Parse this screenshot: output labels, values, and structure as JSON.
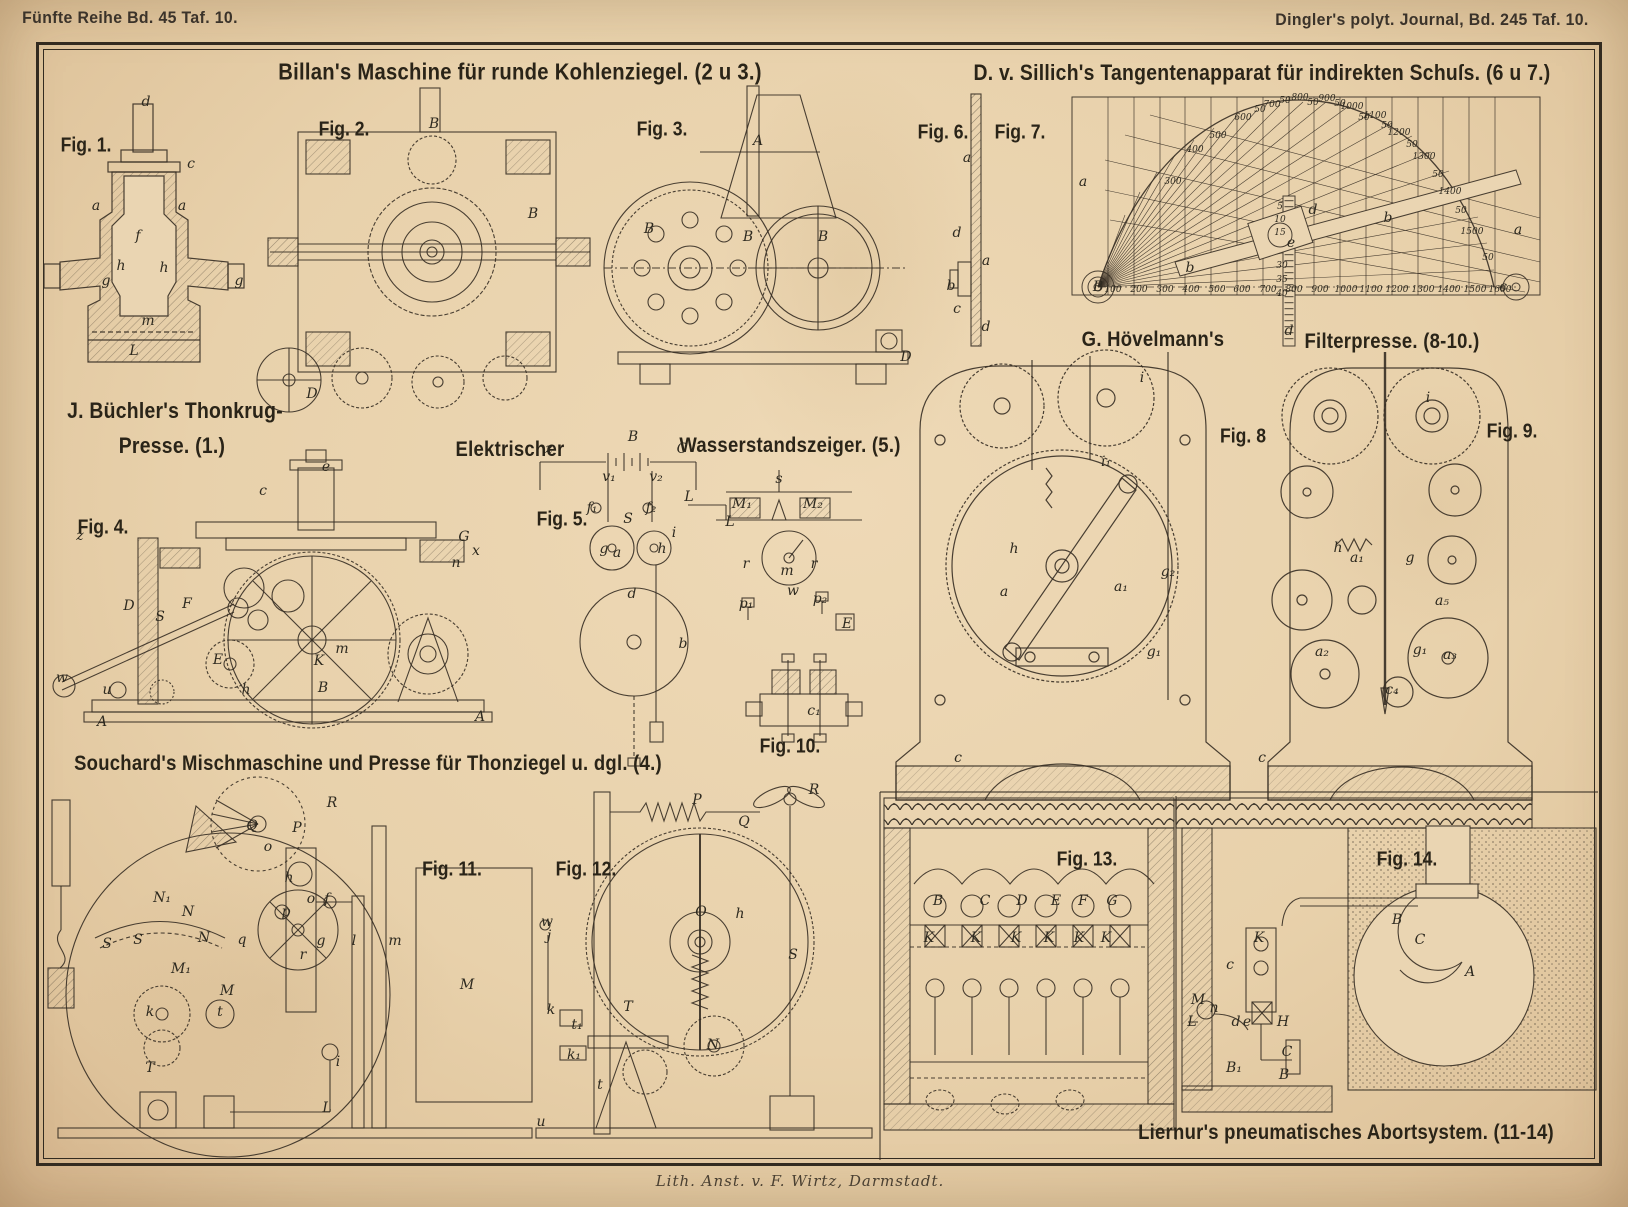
{
  "page": {
    "header_left": "Fünfte Reihe Bd. 45 Taf. 10.",
    "header_right": "Dingler's polyt. Journal, Bd. 245 Taf. 10.",
    "imprint": "Lith. Anst. v. F. Wirtz, Darmstadt."
  },
  "titles": [
    {
      "t": "Billan's Maschine für runde Kohlenziegel. (2 u 3.)",
      "x": 520,
      "y": 72,
      "s": 23
    },
    {
      "t": "D. v. Sillich's Tangentenapparat für indirekten Schuſs. (6 u 7.)",
      "x": 1262,
      "y": 73,
      "s": 22
    },
    {
      "t": "J. Büchler's Thonkrug-",
      "x": 175,
      "y": 411,
      "s": 22
    },
    {
      "t": "Presse. (1.)",
      "x": 172,
      "y": 446,
      "s": 22
    },
    {
      "t": "Elektrischer",
      "x": 510,
      "y": 450,
      "s": 21
    },
    {
      "t": "Wasserstandszeiger. (5.)",
      "x": 790,
      "y": 446,
      "s": 21
    },
    {
      "t": "G. Hövelmann's",
      "x": 1153,
      "y": 340,
      "s": 21
    },
    {
      "t": "Filterpresse. (8-10.)",
      "x": 1392,
      "y": 342,
      "s": 21
    },
    {
      "t": "Souchard's Mischmaschine und Presse für Thonziegel u. dgl. (4.)",
      "x": 368,
      "y": 764,
      "s": 21
    },
    {
      "t": "Liernur's pneumatisches Abortsystem. (11-14)",
      "x": 1346,
      "y": 1133,
      "s": 21
    }
  ],
  "figure_labels": [
    {
      "t": "Fig. 1.",
      "x": 86,
      "y": 146
    },
    {
      "t": "Fig. 2.",
      "x": 344,
      "y": 130
    },
    {
      "t": "Fig. 3.",
      "x": 662,
      "y": 130
    },
    {
      "t": "Fig. 4.",
      "x": 103,
      "y": 528
    },
    {
      "t": "Fig. 5.",
      "x": 562,
      "y": 520
    },
    {
      "t": "Fig. 6.",
      "x": 943,
      "y": 133
    },
    {
      "t": "Fig. 7.",
      "x": 1020,
      "y": 133
    },
    {
      "t": "Fig. 8",
      "x": 1243,
      "y": 437
    },
    {
      "t": "Fig. 9.",
      "x": 1512,
      "y": 432
    },
    {
      "t": "Fig. 10.",
      "x": 790,
      "y": 747
    },
    {
      "t": "Fig. 11.",
      "x": 452,
      "y": 870
    },
    {
      "t": "Fig. 12.",
      "x": 586,
      "y": 870
    },
    {
      "t": "Fig. 13.",
      "x": 1087,
      "y": 860
    },
    {
      "t": "Fig. 14.",
      "x": 1407,
      "y": 860
    }
  ],
  "part_labels": [
    {
      "t": "d",
      "x": 146,
      "y": 102
    },
    {
      "t": "c",
      "x": 191,
      "y": 164
    },
    {
      "t": "a",
      "x": 96,
      "y": 206
    },
    {
      "t": "a",
      "x": 182,
      "y": 206
    },
    {
      "t": "f",
      "x": 138,
      "y": 236
    },
    {
      "t": "h",
      "x": 121,
      "y": 266
    },
    {
      "t": "h",
      "x": 164,
      "y": 268
    },
    {
      "t": "g",
      "x": 106,
      "y": 281
    },
    {
      "t": "g",
      "x": 239,
      "y": 281
    },
    {
      "t": "m",
      "x": 148,
      "y": 321
    },
    {
      "t": "L",
      "x": 134,
      "y": 351
    },
    {
      "t": "B",
      "x": 434,
      "y": 124
    },
    {
      "t": "B",
      "x": 533,
      "y": 214
    },
    {
      "t": "D",
      "x": 312,
      "y": 394
    },
    {
      "t": "A",
      "x": 758,
      "y": 141
    },
    {
      "t": "B",
      "x": 649,
      "y": 229
    },
    {
      "t": "B",
      "x": 748,
      "y": 237
    },
    {
      "t": "B",
      "x": 823,
      "y": 237
    },
    {
      "t": "D",
      "x": 906,
      "y": 357
    },
    {
      "t": "z",
      "x": 80,
      "y": 536
    },
    {
      "t": "e",
      "x": 326,
      "y": 467
    },
    {
      "t": "c",
      "x": 263,
      "y": 491
    },
    {
      "t": "G",
      "x": 464,
      "y": 537
    },
    {
      "t": "x",
      "x": 476,
      "y": 551
    },
    {
      "t": "n",
      "x": 456,
      "y": 563
    },
    {
      "t": "F",
      "x": 187,
      "y": 604
    },
    {
      "t": "S",
      "x": 160,
      "y": 617
    },
    {
      "t": "D",
      "x": 129,
      "y": 606
    },
    {
      "t": "E",
      "x": 218,
      "y": 660
    },
    {
      "t": "m",
      "x": 342,
      "y": 649
    },
    {
      "t": "K",
      "x": 319,
      "y": 661
    },
    {
      "t": "B",
      "x": 323,
      "y": 688
    },
    {
      "t": "h",
      "x": 246,
      "y": 690
    },
    {
      "t": "w",
      "x": 62,
      "y": 678
    },
    {
      "t": "u",
      "x": 107,
      "y": 690
    },
    {
      "t": "A",
      "x": 102,
      "y": 722
    },
    {
      "t": "A",
      "x": 480,
      "y": 717
    },
    {
      "t": "z",
      "x": 549,
      "y": 449
    },
    {
      "t": "B",
      "x": 633,
      "y": 437
    },
    {
      "t": "C",
      "x": 682,
      "y": 449
    },
    {
      "t": "v₁",
      "x": 609,
      "y": 477
    },
    {
      "t": "v₂",
      "x": 656,
      "y": 477
    },
    {
      "t": "f₁",
      "x": 592,
      "y": 508
    },
    {
      "t": "f₂",
      "x": 651,
      "y": 508
    },
    {
      "t": "L",
      "x": 689,
      "y": 497
    },
    {
      "t": "L",
      "x": 730,
      "y": 522
    },
    {
      "t": "i",
      "x": 674,
      "y": 533
    },
    {
      "t": "S",
      "x": 628,
      "y": 519
    },
    {
      "t": "g",
      "x": 604,
      "y": 549
    },
    {
      "t": "a",
      "x": 617,
      "y": 553
    },
    {
      "t": "h",
      "x": 662,
      "y": 549
    },
    {
      "t": "d",
      "x": 632,
      "y": 594
    },
    {
      "t": "b",
      "x": 683,
      "y": 644
    },
    {
      "t": "s",
      "x": 779,
      "y": 479
    },
    {
      "t": "M₁",
      "x": 742,
      "y": 504
    },
    {
      "t": "M₂",
      "x": 813,
      "y": 504
    },
    {
      "t": "r",
      "x": 746,
      "y": 564
    },
    {
      "t": "r",
      "x": 814,
      "y": 564
    },
    {
      "t": "m",
      "x": 787,
      "y": 571
    },
    {
      "t": "w",
      "x": 793,
      "y": 591
    },
    {
      "t": "p₁",
      "x": 746,
      "y": 604
    },
    {
      "t": "p₂",
      "x": 820,
      "y": 599
    },
    {
      "t": "E",
      "x": 847,
      "y": 624
    },
    {
      "t": "c₁",
      "x": 814,
      "y": 711
    },
    {
      "t": "a",
      "x": 967,
      "y": 158
    },
    {
      "t": "d",
      "x": 957,
      "y": 233
    },
    {
      "t": "a",
      "x": 986,
      "y": 261
    },
    {
      "t": "b",
      "x": 951,
      "y": 286
    },
    {
      "t": "c",
      "x": 957,
      "y": 309
    },
    {
      "t": "d",
      "x": 986,
      "y": 327
    },
    {
      "t": "a",
      "x": 1083,
      "y": 182
    },
    {
      "t": "b",
      "x": 1190,
      "y": 268
    },
    {
      "t": "b",
      "x": 1388,
      "y": 218
    },
    {
      "t": "d",
      "x": 1313,
      "y": 210
    },
    {
      "t": "e",
      "x": 1291,
      "y": 243
    },
    {
      "t": "a",
      "x": 1518,
      "y": 230
    },
    {
      "t": "c",
      "x": 1503,
      "y": 287
    },
    {
      "t": "d",
      "x": 1289,
      "y": 331
    },
    {
      "t": "i",
      "x": 1142,
      "y": 378
    },
    {
      "t": "i₁",
      "x": 1106,
      "y": 462
    },
    {
      "t": "h",
      "x": 1014,
      "y": 549
    },
    {
      "t": "g₂",
      "x": 1168,
      "y": 572
    },
    {
      "t": "a",
      "x": 1004,
      "y": 592
    },
    {
      "t": "a₁",
      "x": 1121,
      "y": 587
    },
    {
      "t": "g₁",
      "x": 1154,
      "y": 652
    },
    {
      "t": "c",
      "x": 958,
      "y": 758
    },
    {
      "t": "i",
      "x": 1428,
      "y": 398
    },
    {
      "t": "h",
      "x": 1338,
      "y": 548
    },
    {
      "t": "a₁",
      "x": 1357,
      "y": 558
    },
    {
      "t": "g",
      "x": 1410,
      "y": 558
    },
    {
      "t": "a₅",
      "x": 1442,
      "y": 601
    },
    {
      "t": "a₂",
      "x": 1322,
      "y": 652
    },
    {
      "t": "g₁",
      "x": 1420,
      "y": 650
    },
    {
      "t": "a₃",
      "x": 1450,
      "y": 655
    },
    {
      "t": "c₄",
      "x": 1392,
      "y": 690
    },
    {
      "t": "c",
      "x": 1262,
      "y": 758
    },
    {
      "t": "R",
      "x": 332,
      "y": 803
    },
    {
      "t": "Q",
      "x": 252,
      "y": 826
    },
    {
      "t": "P",
      "x": 297,
      "y": 828
    },
    {
      "t": "o",
      "x": 268,
      "y": 847
    },
    {
      "t": "h",
      "x": 289,
      "y": 878
    },
    {
      "t": "o",
      "x": 311,
      "y": 899
    },
    {
      "t": "f",
      "x": 327,
      "y": 899
    },
    {
      "t": "N₁",
      "x": 162,
      "y": 898
    },
    {
      "t": "N",
      "x": 188,
      "y": 912
    },
    {
      "t": "p",
      "x": 286,
      "y": 912
    },
    {
      "t": "S",
      "x": 107,
      "y": 944
    },
    {
      "t": "S",
      "x": 138,
      "y": 940
    },
    {
      "t": "N",
      "x": 204,
      "y": 938
    },
    {
      "t": "q",
      "x": 242,
      "y": 940
    },
    {
      "t": "r",
      "x": 303,
      "y": 955
    },
    {
      "t": "g",
      "x": 321,
      "y": 941
    },
    {
      "t": "l",
      "x": 354,
      "y": 941
    },
    {
      "t": "m",
      "x": 395,
      "y": 941
    },
    {
      "t": "M₁",
      "x": 181,
      "y": 969
    },
    {
      "t": "M",
      "x": 227,
      "y": 991
    },
    {
      "t": "k",
      "x": 150,
      "y": 1012
    },
    {
      "t": "t",
      "x": 220,
      "y": 1012
    },
    {
      "t": "T",
      "x": 150,
      "y": 1068
    },
    {
      "t": "i",
      "x": 338,
      "y": 1062
    },
    {
      "t": "L",
      "x": 327,
      "y": 1108
    },
    {
      "t": "P",
      "x": 697,
      "y": 800
    },
    {
      "t": "Q",
      "x": 744,
      "y": 822
    },
    {
      "t": "R",
      "x": 814,
      "y": 790
    },
    {
      "t": "w",
      "x": 547,
      "y": 922
    },
    {
      "t": "j",
      "x": 549,
      "y": 936
    },
    {
      "t": "M",
      "x": 467,
      "y": 985
    },
    {
      "t": "O",
      "x": 701,
      "y": 912
    },
    {
      "t": "h",
      "x": 740,
      "y": 914
    },
    {
      "t": "k",
      "x": 551,
      "y": 1010
    },
    {
      "t": "t₁",
      "x": 577,
      "y": 1025
    },
    {
      "t": "k₁",
      "x": 574,
      "y": 1055
    },
    {
      "t": "T",
      "x": 628,
      "y": 1007
    },
    {
      "t": "t",
      "x": 600,
      "y": 1085
    },
    {
      "t": "N",
      "x": 713,
      "y": 1045
    },
    {
      "t": "S",
      "x": 793,
      "y": 955
    },
    {
      "t": "u",
      "x": 541,
      "y": 1122
    },
    {
      "t": "B",
      "x": 938,
      "y": 901
    },
    {
      "t": "C",
      "x": 985,
      "y": 901
    },
    {
      "t": "D",
      "x": 1022,
      "y": 901
    },
    {
      "t": "E",
      "x": 1056,
      "y": 901
    },
    {
      "t": "F",
      "x": 1083,
      "y": 901
    },
    {
      "t": "G",
      "x": 1112,
      "y": 901
    },
    {
      "t": "K",
      "x": 929,
      "y": 938
    },
    {
      "t": "K",
      "x": 976,
      "y": 938
    },
    {
      "t": "K",
      "x": 1016,
      "y": 938
    },
    {
      "t": "K",
      "x": 1049,
      "y": 938
    },
    {
      "t": "K",
      "x": 1079,
      "y": 938
    },
    {
      "t": "K",
      "x": 1106,
      "y": 938
    },
    {
      "t": "K",
      "x": 1259,
      "y": 938
    },
    {
      "t": "c",
      "x": 1230,
      "y": 965
    },
    {
      "t": "M",
      "x": 1198,
      "y": 1000
    },
    {
      "t": "n",
      "x": 1214,
      "y": 1008
    },
    {
      "t": "d",
      "x": 1236,
      "y": 1022
    },
    {
      "t": "e",
      "x": 1247,
      "y": 1022
    },
    {
      "t": "L",
      "x": 1192,
      "y": 1022
    },
    {
      "t": "H",
      "x": 1283,
      "y": 1022
    },
    {
      "t": "C",
      "x": 1287,
      "y": 1052
    },
    {
      "t": "B₁",
      "x": 1234,
      "y": 1068
    },
    {
      "t": "B",
      "x": 1284,
      "y": 1075
    },
    {
      "t": "B",
      "x": 1397,
      "y": 920
    },
    {
      "t": "C",
      "x": 1420,
      "y": 940
    },
    {
      "t": "A",
      "x": 1470,
      "y": 972
    },
    {
      "t": "B",
      "x": 1098,
      "y": 287
    }
  ],
  "fig7_numbers": [
    {
      "t": "100",
      "x": 1113,
      "y": 290
    },
    {
      "t": "200",
      "x": 1139,
      "y": 290
    },
    {
      "t": "300",
      "x": 1165,
      "y": 290
    },
    {
      "t": "400",
      "x": 1191,
      "y": 290
    },
    {
      "t": "500",
      "x": 1217,
      "y": 290
    },
    {
      "t": "600",
      "x": 1242,
      "y": 290
    },
    {
      "t": "700",
      "x": 1268,
      "y": 290
    },
    {
      "t": "800",
      "x": 1294,
      "y": 290
    },
    {
      "t": "900",
      "x": 1320,
      "y": 290
    },
    {
      "t": "1000",
      "x": 1346,
      "y": 290
    },
    {
      "t": "1100",
      "x": 1371,
      "y": 290
    },
    {
      "t": "1200",
      "x": 1397,
      "y": 290
    },
    {
      "t": "1300",
      "x": 1423,
      "y": 290
    },
    {
      "t": "1400",
      "x": 1449,
      "y": 290
    },
    {
      "t": "1500",
      "x": 1475,
      "y": 290
    },
    {
      "t": "1600",
      "x": 1500,
      "y": 290
    },
    {
      "t": "300",
      "x": 1173,
      "y": 182
    },
    {
      "t": "400",
      "x": 1195,
      "y": 150
    },
    {
      "t": "500",
      "x": 1218,
      "y": 136
    },
    {
      "t": "600",
      "x": 1243,
      "y": 118
    },
    {
      "t": "50",
      "x": 1260,
      "y": 110
    },
    {
      "t": "700",
      "x": 1272,
      "y": 105
    },
    {
      "t": "50",
      "x": 1285,
      "y": 101
    },
    {
      "t": "800",
      "x": 1300,
      "y": 98
    },
    {
      "t": "50",
      "x": 1313,
      "y": 103
    },
    {
      "t": "900",
      "x": 1327,
      "y": 99
    },
    {
      "t": "50",
      "x": 1340,
      "y": 104
    },
    {
      "t": "1000",
      "x": 1352,
      "y": 107
    },
    {
      "t": "50",
      "x": 1364,
      "y": 118
    },
    {
      "t": "1100",
      "x": 1375,
      "y": 116
    },
    {
      "t": "50",
      "x": 1387,
      "y": 126
    },
    {
      "t": "1200",
      "x": 1399,
      "y": 133
    },
    {
      "t": "50",
      "x": 1412,
      "y": 145
    },
    {
      "t": "1300",
      "x": 1424,
      "y": 157
    },
    {
      "t": "50",
      "x": 1438,
      "y": 175
    },
    {
      "t": "1400",
      "x": 1450,
      "y": 192
    },
    {
      "t": "50",
      "x": 1461,
      "y": 211
    },
    {
      "t": "1500",
      "x": 1472,
      "y": 232
    },
    {
      "t": "50",
      "x": 1488,
      "y": 258
    },
    {
      "t": "5",
      "x": 1280,
      "y": 207
    },
    {
      "t": "10",
      "x": 1280,
      "y": 220
    },
    {
      "t": "15",
      "x": 1280,
      "y": 233
    },
    {
      "t": "30",
      "x": 1282,
      "y": 266
    },
    {
      "t": "35",
      "x": 1282,
      "y": 280
    },
    {
      "t": "40",
      "x": 1282,
      "y": 294
    }
  ],
  "chart_data": {
    "type": "line",
    "title": "Tangentenapparat für indirekten Schuſs (Fig. 7)",
    "x_ticks": [
      100,
      200,
      300,
      400,
      500,
      600,
      700,
      800,
      900,
      1000,
      1100,
      1200,
      1300,
      1400,
      1500,
      1600
    ],
    "arc_labels": [
      300,
      400,
      500,
      600,
      700,
      800,
      900,
      1000,
      1100,
      1200,
      1300,
      1400,
      1500
    ],
    "intermediate_label": "50",
    "ruler_scale": [
      5,
      10,
      15,
      30,
      35,
      40
    ],
    "grid": true,
    "legend_position": "none"
  }
}
